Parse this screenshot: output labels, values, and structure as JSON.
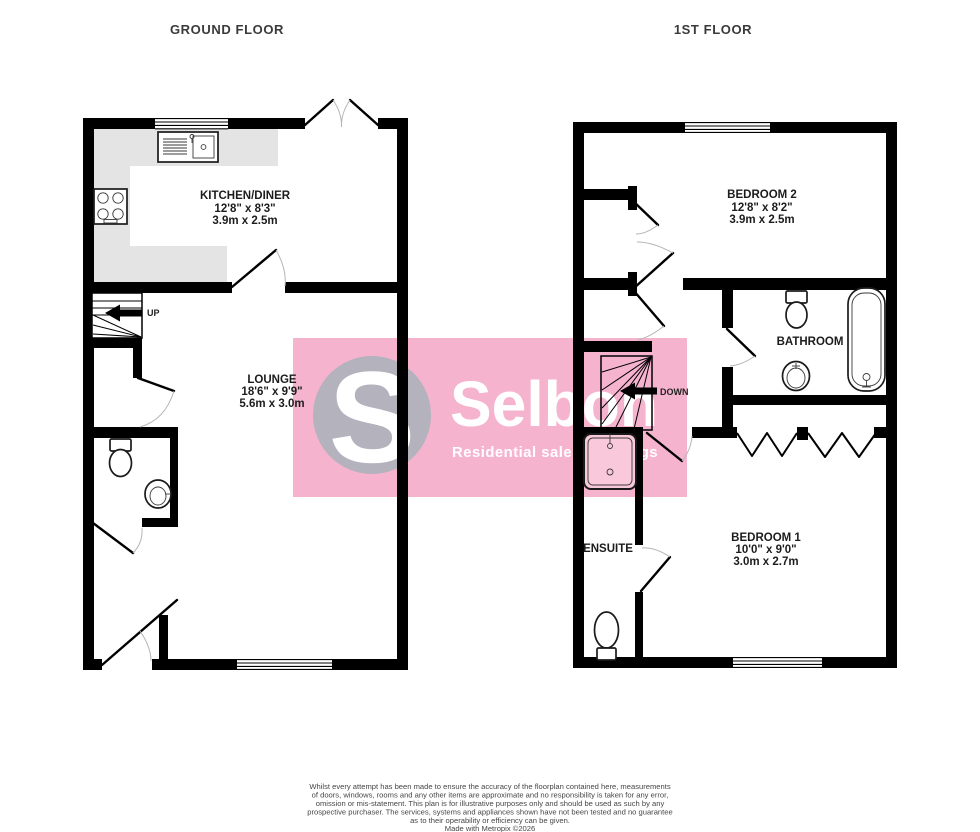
{
  "titles": {
    "ground": "GROUND FLOOR",
    "first": "1ST FLOOR"
  },
  "rooms": {
    "kitchen": {
      "name": "KITCHEN/DINER",
      "imperial": "12'8\"  x 8'3\"",
      "metric": "3.9m  x 2.5m"
    },
    "lounge": {
      "name": "LOUNGE",
      "imperial": "18'6\"  x 9'9\"",
      "metric": "5.6m  x 3.0m"
    },
    "bedroom2": {
      "name": "BEDROOM 2",
      "imperial": "12'8\"  x 8'2\"",
      "metric": "3.9m  x 2.5m"
    },
    "bathroom": {
      "name": "BATHROOM"
    },
    "bedroom1": {
      "name": "BEDROOM 1",
      "imperial": "10'0\"  x 9'0\"",
      "metric": "3.0m  x 2.7m"
    },
    "ensuite": {
      "name": "ENSUITE"
    }
  },
  "stairs": {
    "up": "UP",
    "down": "DOWN"
  },
  "watermark": {
    "initial": "S",
    "brand": "Selbon",
    "tagline": "Residential sales & lettings",
    "colors": {
      "pink": "#f6b3ce",
      "circle": "#b3b2bd",
      "text": "#ffffff"
    }
  },
  "colors": {
    "wall": "#000000",
    "counter": "#e4e4e4"
  },
  "footer": {
    "lines": [
      "Whilst every attempt has been made to ensure the accuracy of the floorplan contained here, measurements",
      "of doors, windows, rooms and any other items are approximate and no responsibility is taken for any error,",
      "omission or mis-statement. This plan is for illustrative purposes only and should be used as such by any",
      "prospective purchaser. The services, systems and appliances shown have not been tested and no guarantee",
      "as to their operability or efficiency can be given.",
      "Made with Metropix ©2026"
    ]
  }
}
